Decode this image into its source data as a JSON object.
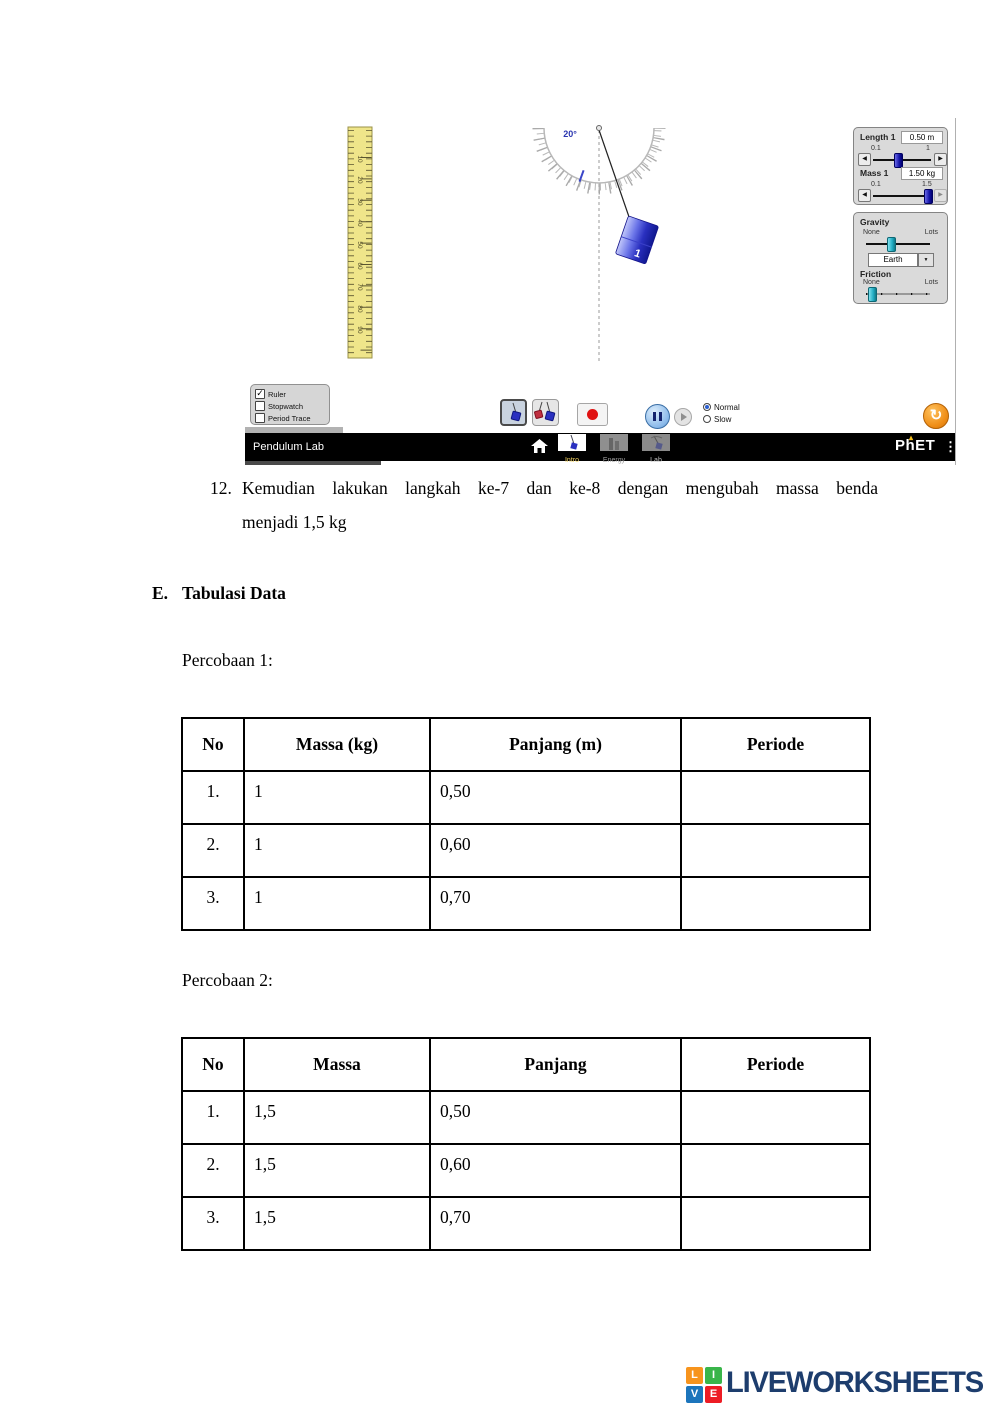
{
  "sim": {
    "navbar": {
      "title": "Pendulum Lab",
      "tabs": [
        {
          "label": "Intro",
          "selected": true
        },
        {
          "label": "Energy",
          "selected": false
        },
        {
          "label": "Lab",
          "selected": false
        }
      ],
      "brand": "PhET"
    },
    "scene": {
      "angle_label": "20°",
      "mass_label": "1",
      "ruler_numbers": [
        "10",
        "20",
        "30",
        "40",
        "50",
        "60",
        "70",
        "80",
        "90"
      ]
    },
    "tools": {
      "checkboxes": [
        {
          "label": "Ruler",
          "checked": true
        },
        {
          "label": "Stopwatch",
          "checked": false
        },
        {
          "label": "Period Trace",
          "checked": false
        }
      ]
    },
    "speed": {
      "options": [
        {
          "label": "Normal",
          "selected": true
        },
        {
          "label": "Slow",
          "selected": false
        }
      ]
    },
    "controls": {
      "length": {
        "label": "Length 1",
        "value": "0.50 m",
        "min": "0.1",
        "max": "1"
      },
      "mass": {
        "label": "Mass 1",
        "value": "1.50 kg",
        "min": "0.1",
        "max": "1.5"
      },
      "gravity": {
        "label": "Gravity",
        "min": "None",
        "max": "Lots",
        "selected_body": "Earth"
      },
      "friction": {
        "label": "Friction",
        "min": "None",
        "max": "Lots"
      }
    },
    "colors": {
      "slider_handle_blue": "#1515a8",
      "slider_handle_cyan": "#23aec4",
      "record_red": "#e01212",
      "reset_orange": "#ef8d16",
      "tab_selected_text": "#f0d060"
    }
  },
  "document": {
    "item12": {
      "number": "12.",
      "line1": "Kemudian lakukan langkah ke-7 dan ke-8 dengan mengubah massa benda",
      "line2": "menjadi 1,5 kg"
    },
    "section": {
      "letter": "E.",
      "title": "Tabulasi Data"
    },
    "experiment1": {
      "caption": "Percobaan 1:",
      "headers": [
        "No",
        "Massa (kg)",
        "Panjang (m)",
        "Periode"
      ],
      "rows": [
        [
          "1.",
          "1",
          "0,50",
          ""
        ],
        [
          "2.",
          "1",
          "0,60",
          ""
        ],
        [
          "3.",
          "1",
          "0,70",
          ""
        ]
      ]
    },
    "experiment2": {
      "caption": "Percobaan 2:",
      "headers": [
        "No",
        "Massa",
        "Panjang",
        "Periode"
      ],
      "rows": [
        [
          "1.",
          "1,5",
          "0,50",
          ""
        ],
        [
          "2.",
          "1,5",
          "0,60",
          ""
        ],
        [
          "3.",
          "1,5",
          "0,70",
          ""
        ]
      ]
    }
  },
  "footer": {
    "brand": "LIVEWORKSHEETS",
    "icon_letters": [
      "L",
      "I",
      "V",
      "E"
    ],
    "brand_color": "#1d3d6d"
  }
}
